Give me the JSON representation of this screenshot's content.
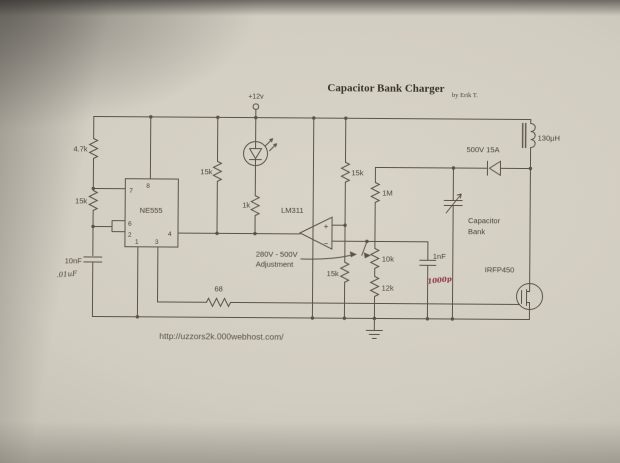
{
  "title": {
    "text": "Capacitor Bank Charger",
    "byline": "by Erik T."
  },
  "supply": {
    "label": "+12v"
  },
  "footer": {
    "url": "http://uzzors2k.000webhost.com/"
  },
  "ic555": {
    "name": "NE555",
    "pin1": "1",
    "pin2": "2",
    "pin3": "3",
    "pin4": "4",
    "pin6": "6",
    "pin7": "7",
    "pin8": "8"
  },
  "comparator": {
    "name": "LM311",
    "plus": "+",
    "minus": "−"
  },
  "resistors": {
    "timing_4k7": "4.7k",
    "timing_15k": "15k",
    "pullup_15k": "15k",
    "led_1k": "1k",
    "ref_top_15k": "15k",
    "ref_bottom_15k": "15k",
    "feedback_1m": "1M",
    "pot_10k": "10k",
    "divider_12k": "12k",
    "gate_68": "68"
  },
  "capacitors": {
    "timing_10nf": "10nF",
    "timing_note": ".01uF",
    "filter_1nf": "1nF",
    "filter_note": "1000p",
    "bank_label_1": "Capacitor",
    "bank_label_2": "Bank"
  },
  "diode": {
    "label": "500V 15A"
  },
  "inductor": {
    "label": "130µH"
  },
  "mosfet": {
    "label": "IRFP450"
  },
  "annotations": {
    "adjust_line1": "280V - 500V",
    "adjust_line2": "Adjustment"
  },
  "colors": {
    "ink": "#5b5349",
    "text": "#48423a",
    "red": "#8e3443"
  }
}
